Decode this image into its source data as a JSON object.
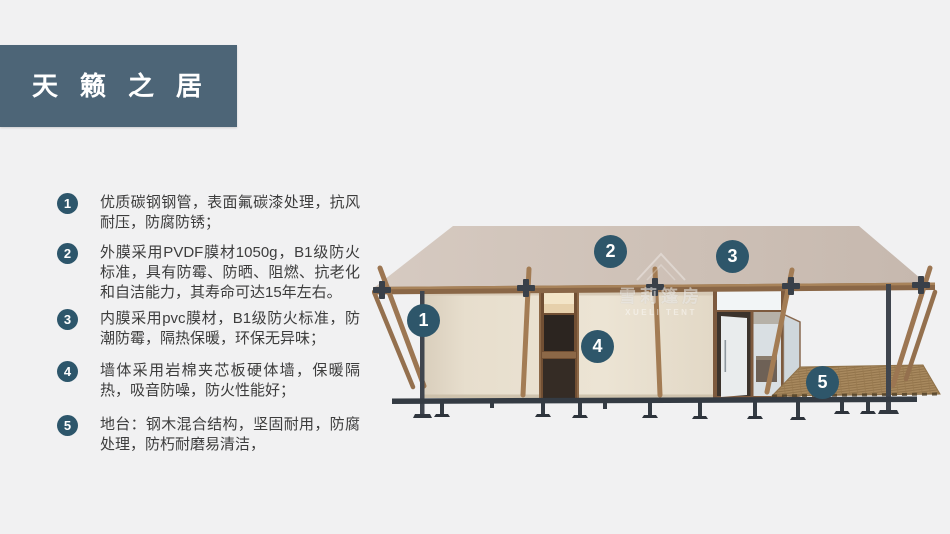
{
  "header": {
    "title": "天籁之居"
  },
  "features": [
    {
      "num": "1",
      "text": "优质碳钢钢管，表面氟碳漆处理，抗风耐压，防腐防锈；"
    },
    {
      "num": "2",
      "text": "外膜采用PVDF膜材1050g，B1级防火标准，具有防霉、防晒、阻燃、抗老化和自洁能力，其寿命可达15年左右。"
    },
    {
      "num": "3",
      "text": "内膜采用pvc膜材，B1级防火标准，防潮防霉，隔热保暖，环保无异味；"
    },
    {
      "num": "4",
      "text": "墙体采用岩棉夹芯板硬体墙，保暖隔热，吸音防噪，防火性能好；"
    },
    {
      "num": "5",
      "text": "地台：钢木混合结构，坚固耐用，防腐处理，防朽耐磨易清洁，"
    }
  ],
  "diagram": {
    "badges": [
      {
        "num": "1"
      },
      {
        "num": "2"
      },
      {
        "num": "3"
      },
      {
        "num": "4"
      },
      {
        "num": "5"
      }
    ],
    "watermark": {
      "cn": "雪莉篷房",
      "en": "XUELI TENT"
    }
  },
  "colors": {
    "background": "#f1f1f2",
    "banner": "#4d6577",
    "badge": "#2e566a",
    "roof": "#ccbfb5",
    "wall": "#e9e1d1",
    "wood": "#9c7652",
    "steel": "#3f454e",
    "text": "#3d3d3d"
  }
}
